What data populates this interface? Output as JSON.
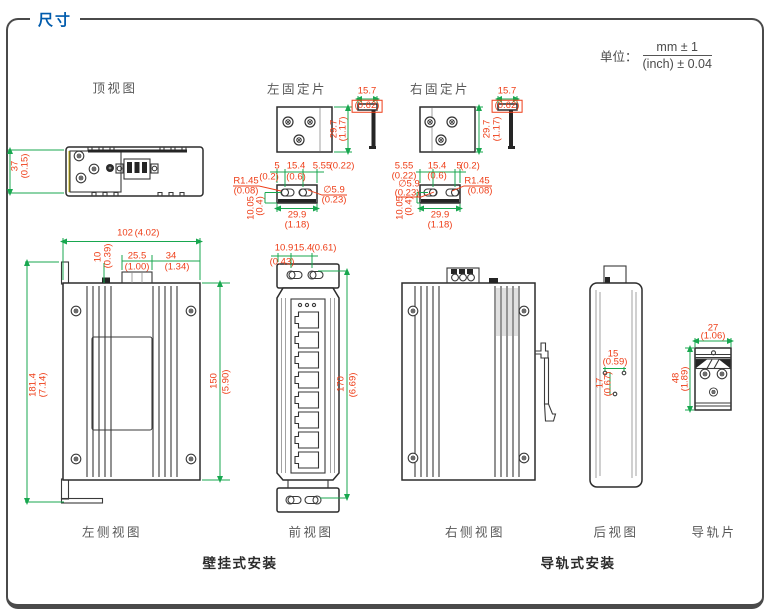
{
  "panel": {
    "title": "尺寸"
  },
  "unit": {
    "label": "单位：",
    "numerator": "mm ± 1",
    "denominator": "(inch) ± 0.04"
  },
  "views": {
    "top": "顶视图",
    "left_plate": "左固定片",
    "right_plate": "右固定片",
    "left_side": "左侧视图",
    "front": "前视图",
    "right_side": "右侧视图",
    "rear": "后视图",
    "rail_plate": "导轨片",
    "wall_mount_section": "壁挂式安装",
    "rail_mount_section": "导轨式安装"
  },
  "dims": {
    "top": {
      "depth": "37",
      "depth_in": "(0.15)"
    },
    "plate": {
      "flange": "15.7",
      "flange_in": "(0.62)",
      "height": "29.7",
      "height_in": "(1.17)",
      "edge": "5",
      "edge_in": "(0.2)",
      "pitch": "15.4",
      "pitch_in": "(0.6)",
      "slot": "5.55",
      "slot_in": "(0.22)",
      "radius": "R1.45",
      "radius_in": "(0.08)",
      "dia": "∅5.9",
      "dia_in": "(0.23)",
      "depth": "10.05",
      "depth_in": "(0.4)",
      "width": "29.9",
      "width_in": "(1.18)"
    },
    "left_side": {
      "width": "102",
      "width_in": "(4.02)",
      "bump": "10",
      "bump_in": "(0.39)",
      "block": "25.5",
      "block_in": "(1.00)",
      "offset": "34",
      "offset_in": "(1.34)",
      "total_height": "181.4",
      "total_height_in": "(7.14)",
      "body_height": "150",
      "body_height_in": "(5.90)"
    },
    "front": {
      "edge": "10.9",
      "edge_in": "(0.43)",
      "pitch": "15.4",
      "pitch_in": "(0.61)",
      "hole_span": "170",
      "hole_span_in": "(6.69)"
    },
    "rear": {
      "pitch": "15",
      "pitch_in": "(0.59)",
      "drop": "17",
      "drop_in": "(0.67)"
    },
    "rail_plate": {
      "width": "27",
      "width_in": "(1.06)",
      "height": "48",
      "height_in": "(1.89)"
    }
  },
  "colors": {
    "title_blue": "#005bac",
    "dim_red": "#ee3d17",
    "dim_green": "#18a74f",
    "line_dark": "#3a3a3a",
    "accent_yellow": "#c9b50a"
  }
}
